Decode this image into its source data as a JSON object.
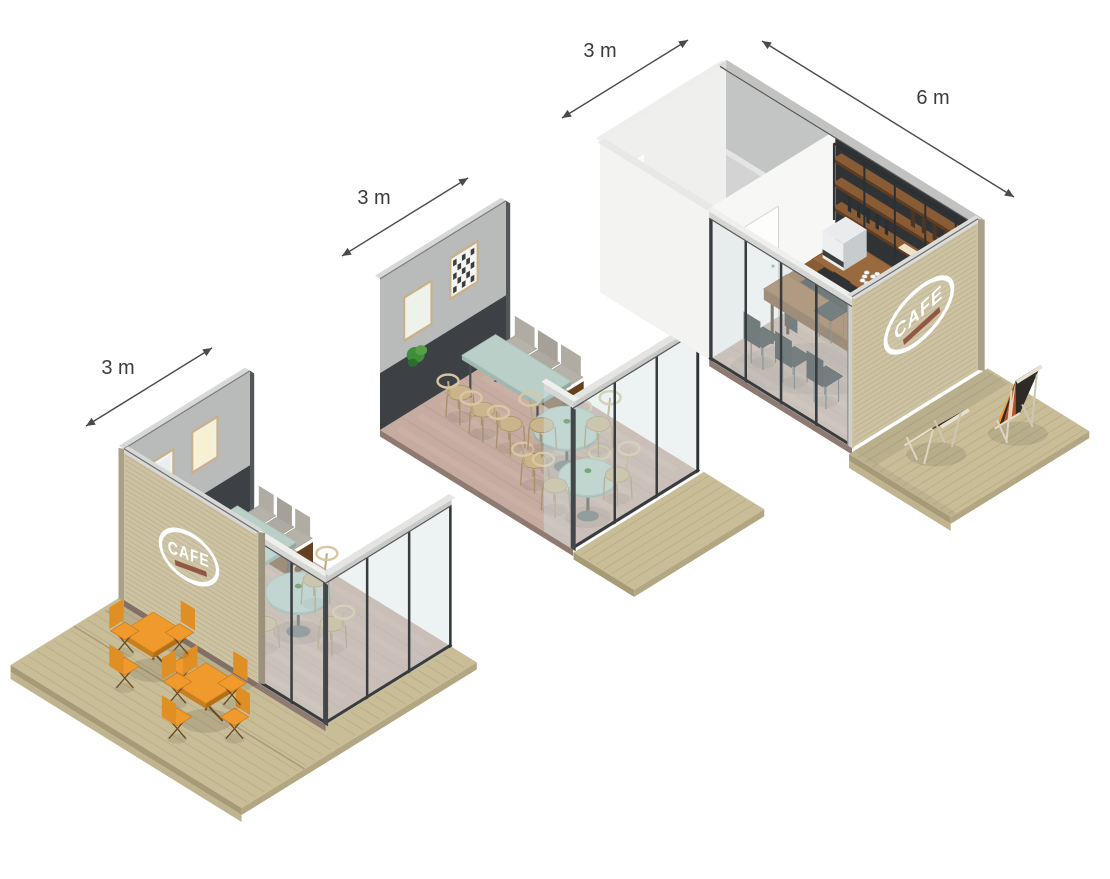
{
  "dimensions": {
    "left_unit_width": "3 m",
    "middle_unit_width": "3 m",
    "right_unit_width": "3 m",
    "right_unit_length": "6 m"
  },
  "logo": {
    "text": "CAFE"
  },
  "palette": {
    "accent_orange": "#f09a2d",
    "mint": "#b9cfc7",
    "wood_brown": "#9a6a3f",
    "shelf_wood": "#8a5c35",
    "bench_wood": "#7b5331",
    "deck_wood": "#c9bd98",
    "floor_wood": "#c6aba0",
    "slat_wood": "#cdc3a3",
    "concrete": "#b9bbba",
    "dark_charcoal": "#34383b",
    "white_wall": "#f3f3f1",
    "glass_tint": "#cfe0df",
    "cushion_gray": "#b6b2a9",
    "frame_dark": "#383c3f",
    "chair_wood": "#c9b48c",
    "logo_white": "#ffffff",
    "logo_accent_red": "#8d4a38",
    "dimension_line": "#4a4a4a",
    "stripe_red": "#c0511f",
    "stripe_dark": "#2e2a26",
    "stripe_cream": "#e8d8c2"
  }
}
